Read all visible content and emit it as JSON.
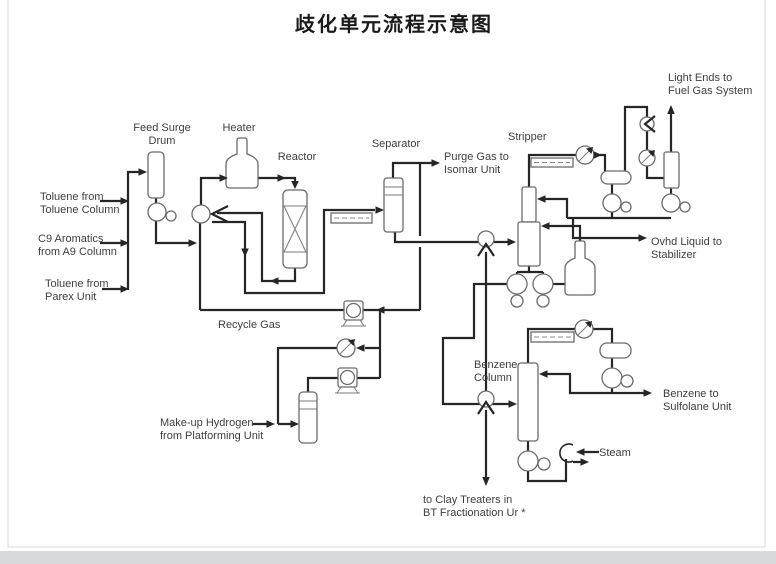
{
  "title": "歧化单元流程示意图",
  "labels": {
    "feed_surge_drum": [
      "Feed Surge",
      "Drum"
    ],
    "heater": "Heater",
    "reactor": "Reactor",
    "separator": "Separator",
    "purge_gas": [
      "Purge Gas to",
      "Isomar Unit"
    ],
    "stripper": "Stripper",
    "light_ends": [
      "Light Ends to",
      "Fuel Gas System"
    ],
    "ovhd_liquid": [
      "Ovhd Liquid to",
      "Stabilizer"
    ],
    "benzene_column": [
      "Benzene",
      "Column"
    ],
    "benzene_product": [
      "Benzene to",
      "Sulfolane Unit"
    ],
    "steam": "Steam",
    "clay_treaters": [
      "to Clay Treaters in",
      "BT Fractionation Ur *"
    ],
    "toluene_from_toluene_column": [
      "Toluene from",
      "Toluene Column"
    ],
    "c9_aromatics": [
      "C9 Aromatics",
      "from A9 Column"
    ],
    "toluene_from_parex": [
      "Toluene from",
      "Parex Unit"
    ],
    "recycle_gas": "Recycle Gas",
    "makeup_hydrogen": [
      "Make-up Hydrogen",
      "from Platforming Unit"
    ]
  },
  "colors": {
    "pipe": "#262626",
    "equipment_outline": "#6b6b6b",
    "label_text": "#3e3e3e",
    "title_text": "#1a1a1a",
    "frame": "#d8d8d8",
    "bottom_bar": "#d7d9da"
  }
}
